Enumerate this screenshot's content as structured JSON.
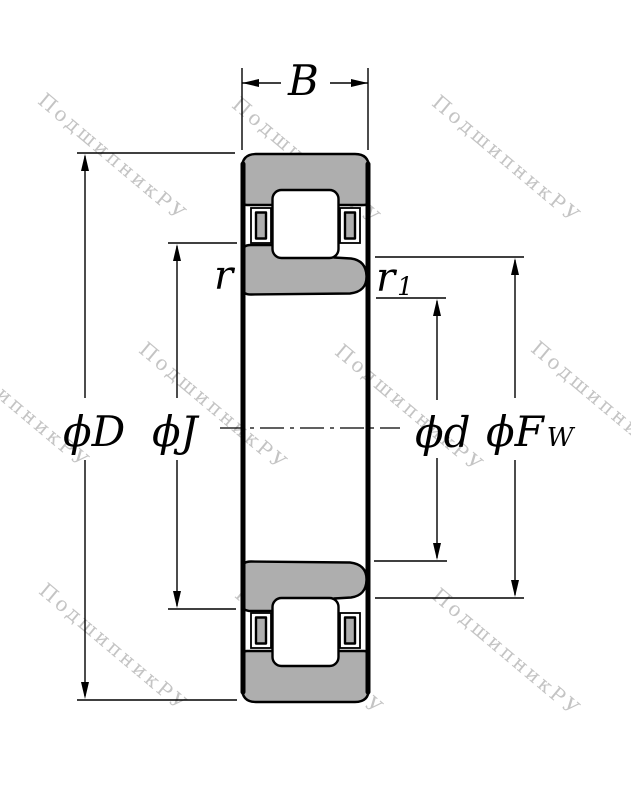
{
  "drawing": {
    "background": "#ffffff",
    "line_color": "#000000",
    "metal_fill": "#aeaeae",
    "type_note": "cylindrical roller bearing cross-section"
  },
  "watermark": {
    "text": "ПодшипникРУ",
    "color": "#c4c4c4"
  },
  "dimensions": {
    "width_label": "B",
    "outer_diameter_label": "ϕD",
    "rib_diameter_label": "ϕJ",
    "bore_diameter_label": "ϕd",
    "raceway_diameter_label": "ϕF",
    "raceway_diameter_sub": "W",
    "outer_chamfer_label": "r",
    "inner_chamfer_label": "r",
    "inner_chamfer_sub": "1"
  }
}
